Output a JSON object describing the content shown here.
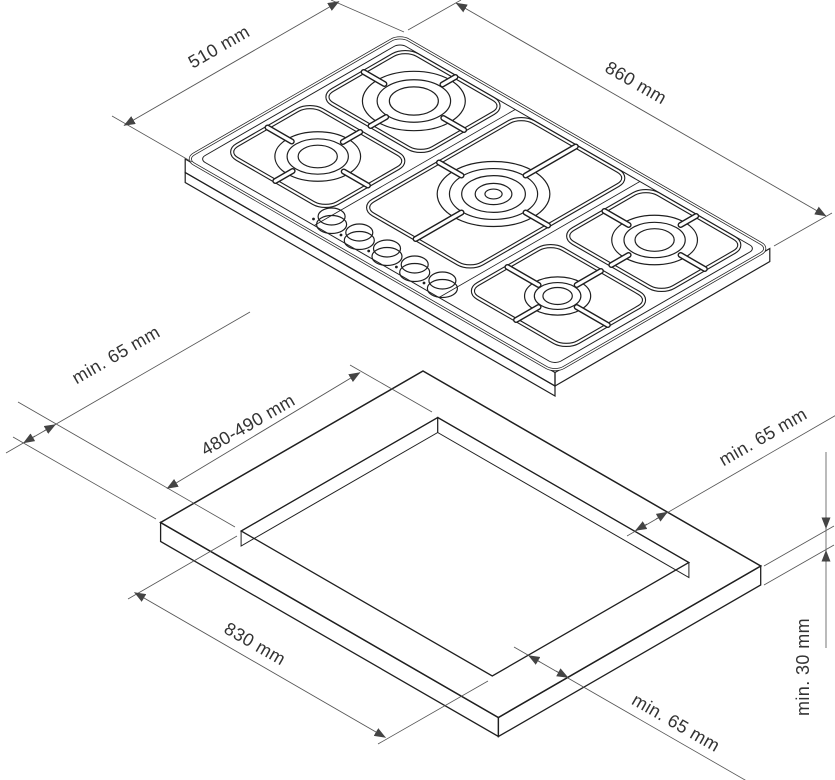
{
  "diagram": {
    "type": "hob-installation-drawing",
    "colors": {
      "line": "#1f1f1f",
      "dimension": "#555555",
      "text": "#333333",
      "background": "#ffffff"
    },
    "hob_view": {
      "depth_dim": "510 mm",
      "width_dim": "860 mm",
      "burner_count": 5,
      "knob_count": 5
    },
    "cutout_view": {
      "clearance_left": "min. 65 mm",
      "cutout_depth": "480-490 mm",
      "clearance_right": "min. 65 mm",
      "cutout_width": "830 mm",
      "clearance_front": "min. 65 mm",
      "worktop_thickness": "min. 30 mm"
    }
  }
}
